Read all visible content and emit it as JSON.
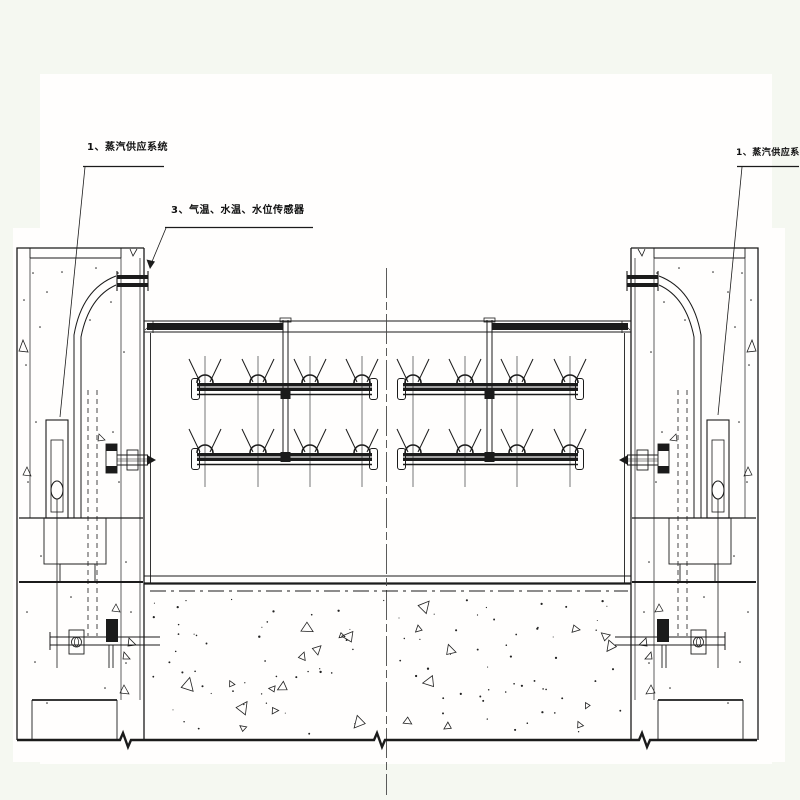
{
  "drawing": {
    "type": "engineering-cross-section",
    "ink_color": "#1b1b1b",
    "paper_color": "#fffefd",
    "page_background": "#f5f8f1"
  },
  "labels": {
    "steam_left": "1、蒸汽供应系统",
    "sensors": "3、气温、水温、水位传感器",
    "steam_right": "1、蒸汽供应系统"
  }
}
